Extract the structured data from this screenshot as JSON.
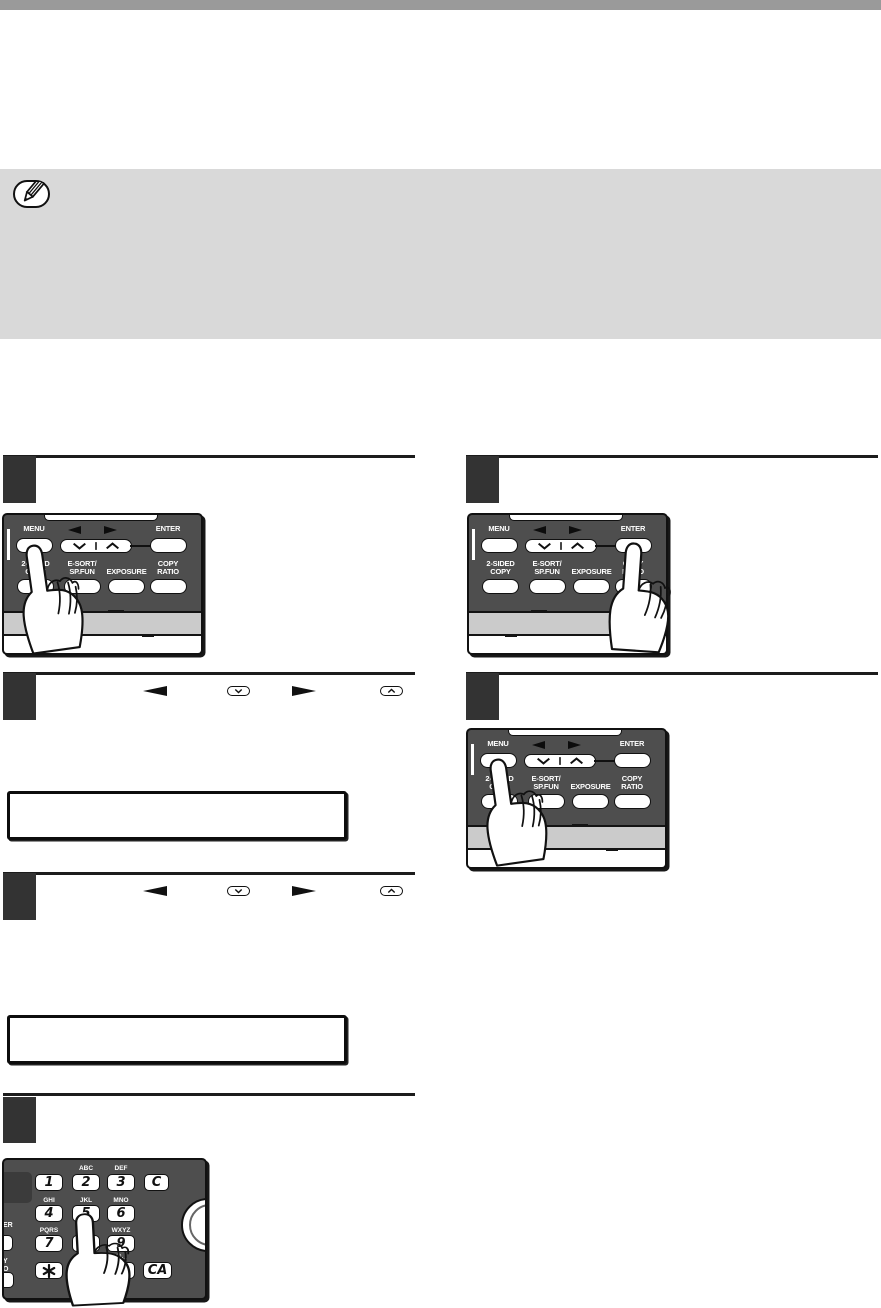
{
  "document": {
    "type": "printer-manual-page",
    "note_box": {
      "icon": "pencil-icon",
      "text": ""
    }
  },
  "steps": [
    {
      "id": "step-1",
      "column": "left",
      "number": "",
      "shows": "pressing MENU key"
    },
    {
      "id": "step-2",
      "column": "right",
      "number": "",
      "shows": "pressing ENTER key"
    },
    {
      "id": "step-3",
      "column": "left",
      "number": "",
      "inline_keys": [
        "left-arrow-key",
        "down-key",
        "right-arrow-key",
        "up-key"
      ]
    },
    {
      "id": "step-4",
      "column": "right",
      "number": "",
      "shows": "pressing MENU key"
    },
    {
      "id": "step-5",
      "column": "left",
      "number": "",
      "inline_keys": [
        "left-arrow-key",
        "down-key",
        "right-arrow-key",
        "up-key"
      ]
    },
    {
      "id": "step-6",
      "column": "left",
      "number": "",
      "shows": "pressing 5 key on keypad"
    }
  ],
  "displays": [
    {
      "id": "display-1",
      "text": ""
    },
    {
      "id": "display-2",
      "text": ""
    }
  ],
  "control_panel": {
    "labels": {
      "menu": "MENU",
      "enter": "ENTER",
      "two_sided": "2-SIDED\nCOPY",
      "esort": "E-SORT/\nSP.FUN",
      "exposure": "EXPOSURE",
      "copy_ratio": "COPY\nRATIO"
    },
    "colors": {
      "panel": "#4e4e4e",
      "band": "#cbcbcb",
      "key_face": "#ffffff"
    }
  },
  "keypad": {
    "keys": {
      "k1": "1",
      "k2": "2",
      "k3": "3",
      "k4": "4",
      "k5": "5",
      "k6": "6",
      "k7": "7",
      "k8": "8",
      "k9": "9",
      "hash": "#",
      "clear": "C",
      "clear_all": "CA"
    },
    "letters": {
      "abc": "ABC",
      "def": "DEF",
      "ghi": "GHI",
      "jkl": "JKL",
      "mno": "MNO",
      "pqrs": "PQRS",
      "wxyz": "WXYZ",
      "at": "@._"
    },
    "edge_fragments": {
      "er": "ER",
      "y": "Y",
      "o": "O"
    }
  }
}
